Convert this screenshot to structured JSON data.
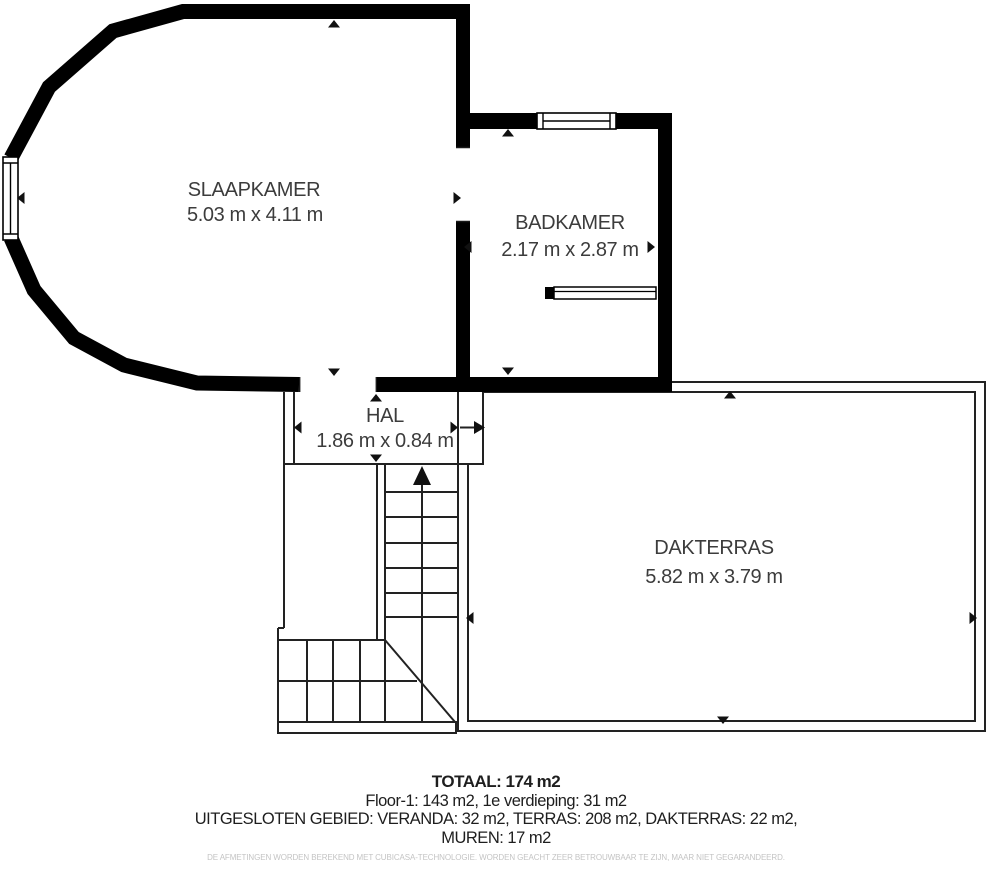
{
  "rooms": {
    "slaapkamer": {
      "name": "SLAAPKAMER",
      "dims": "5.03 m x 4.11 m"
    },
    "badkamer": {
      "name": "BADKAMER",
      "dims": "2.17 m x 2.87 m"
    },
    "hal": {
      "name": "HAL",
      "dims": "1.86 m x 0.84 m"
    },
    "dakterras": {
      "name": "DAKTERRAS",
      "dims": "5.82 m x 3.79 m"
    }
  },
  "summary": {
    "total": "TOTAAL: 174 m2",
    "floors": "Floor-1: 143 m2, 1e verdieping: 31 m2",
    "excluded": "UITGESLOTEN GEBIED: VERANDA: 32 m2, TERRAS: 208 m2, DAKTERRAS: 22 m2,",
    "walls": "MUREN: 17 m2"
  },
  "disclaimer": "DE AFMETINGEN WORDEN BEREKEND MET CUBICASA-TECHNOLOGIE. WORDEN GEACHT ZEER BETROUWBAAR TE ZIJN, MAAR NIET GEGARANDEERD.",
  "colors": {
    "wall": "#000000",
    "line": "#222222",
    "tick": "#111111",
    "room_text": "#3c3c3c",
    "summary_text": "#1e1e1e",
    "disclaimer_text": "#c4c4c4",
    "background": "#ffffff"
  }
}
